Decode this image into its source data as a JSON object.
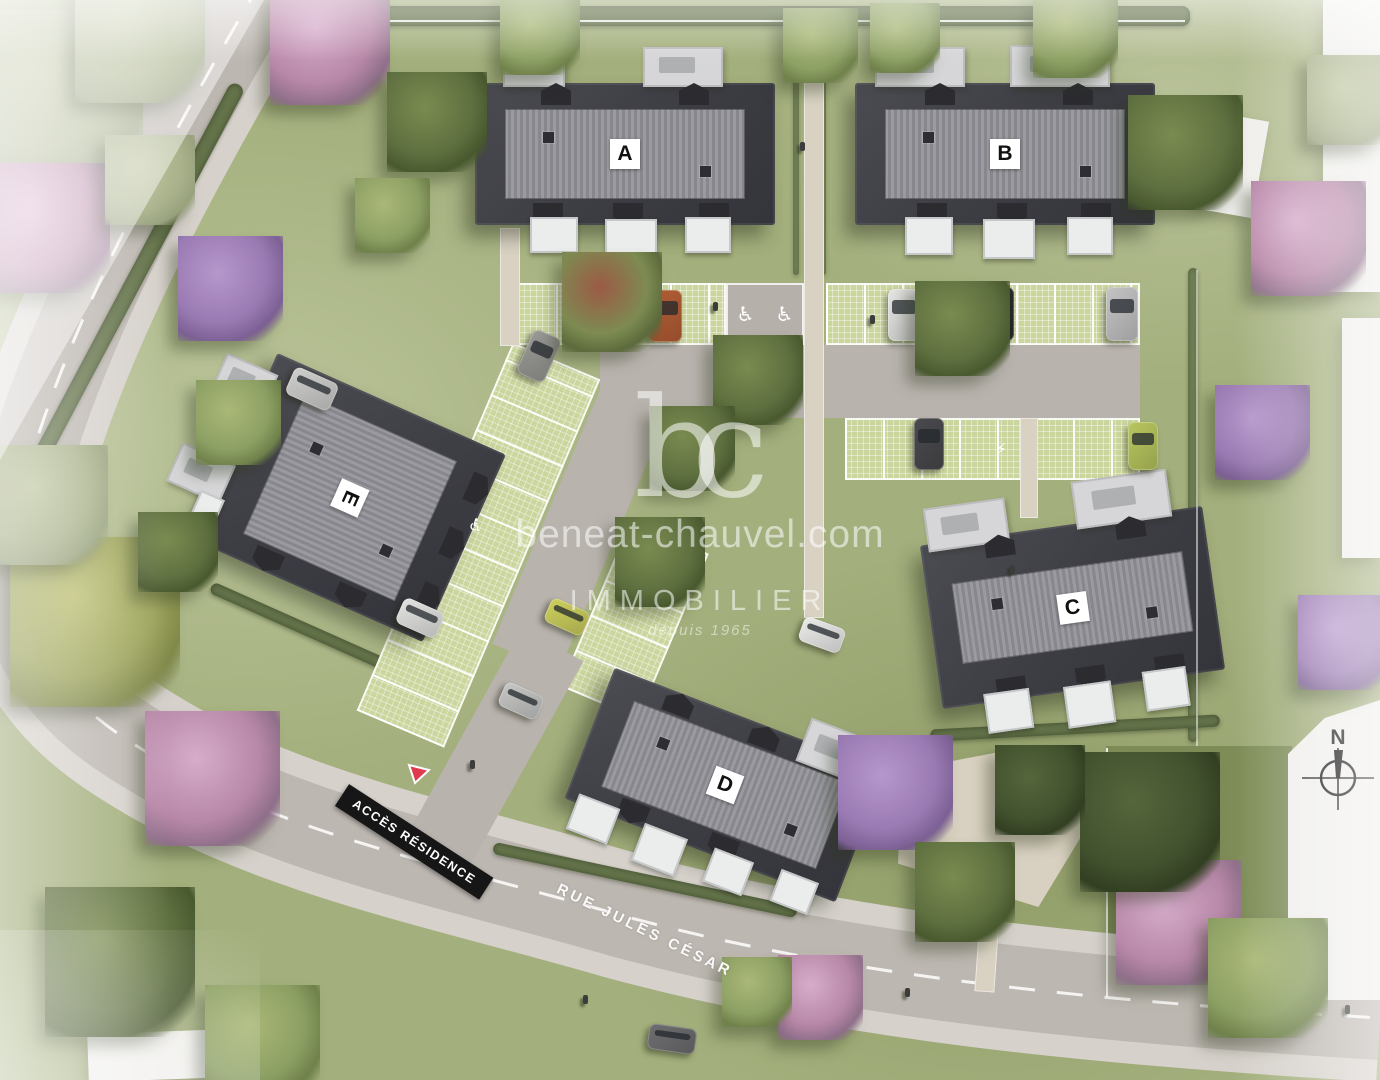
{
  "site": {
    "buildings": [
      {
        "label": "A"
      },
      {
        "label": "B"
      },
      {
        "label": "C"
      },
      {
        "label": "D"
      },
      {
        "label": "E"
      }
    ],
    "signs": {
      "access": "ACCÈS RÉSIDENCE",
      "street": "RUE JULES CÉSAR"
    },
    "watermark": {
      "logo": "bc",
      "domain": "beneat-chauvel.com",
      "brand": "IMMOBILIER",
      "tagline": "depuis 1965"
    },
    "compass": {
      "north": "N"
    },
    "icons": {
      "wheelchair": "♿",
      "ev_charging": "⚡"
    },
    "colors": {
      "roof": "#3d3d44",
      "roof_band": "#95959b",
      "grass": "#a3af7c",
      "pavers": "#cbd69e",
      "road": "#bdb7b1",
      "sign_bg": "#161616",
      "sign_arrow": "#e03a4e",
      "label_bg": "#ffffff",
      "label_text": "#111111"
    }
  }
}
